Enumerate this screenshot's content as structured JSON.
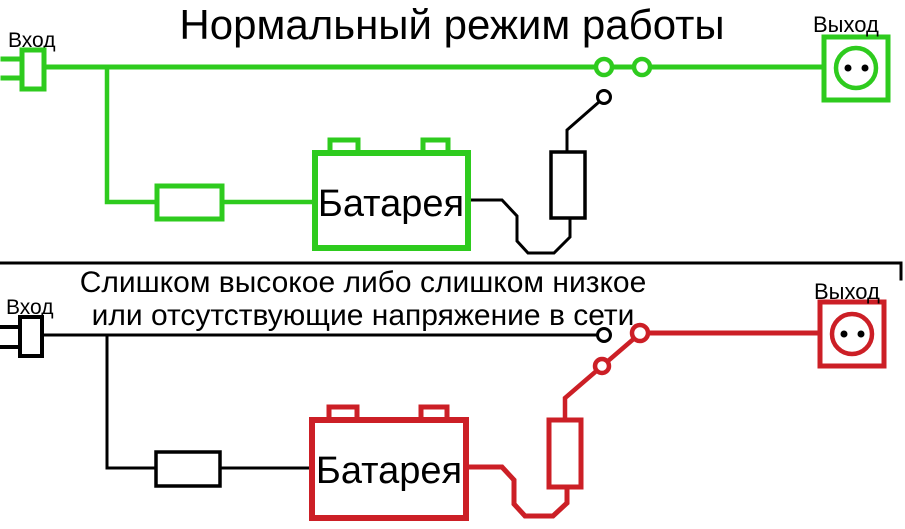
{
  "colors": {
    "green": "#2ecb1e",
    "red": "#cc1f26",
    "ink": "#000000",
    "background": "#ffffff"
  },
  "top_panel": {
    "title": "Нормальный режим работы",
    "input_label": "Вход",
    "output_label": "Выход",
    "battery_label": "Батарея"
  },
  "bottom_panel": {
    "caption_line1": "Слишком высокое либо слишком низкое",
    "caption_line2": "или отсутствующие напряжение в сети",
    "input_label": "Вход",
    "output_label": "Выход",
    "battery_label": "Батарея"
  }
}
